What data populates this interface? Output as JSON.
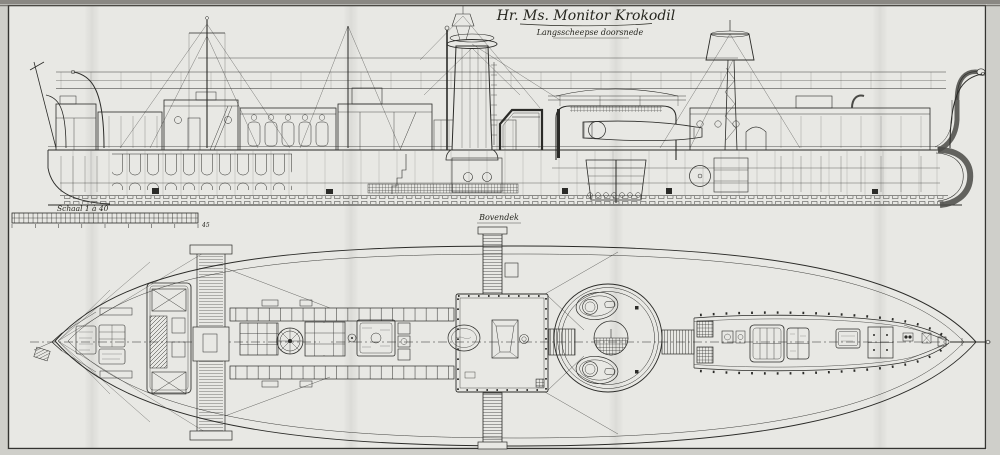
{
  "title_block": {
    "title": "Hr. Ms. Monitor Krokodil",
    "subtitle": "Langsscheepse doorsnede"
  },
  "scale_bar": {
    "label": "Schaal 1 à 40",
    "end_value": "45"
  },
  "plan": {
    "deck_label": "Bovendek"
  },
  "colors": {
    "paper": "#e8e8e4",
    "paper_outside": "#cfcfca",
    "ink": "#2b2b28",
    "frame_line": "#343431",
    "armor_gray": "#4a4a46"
  }
}
